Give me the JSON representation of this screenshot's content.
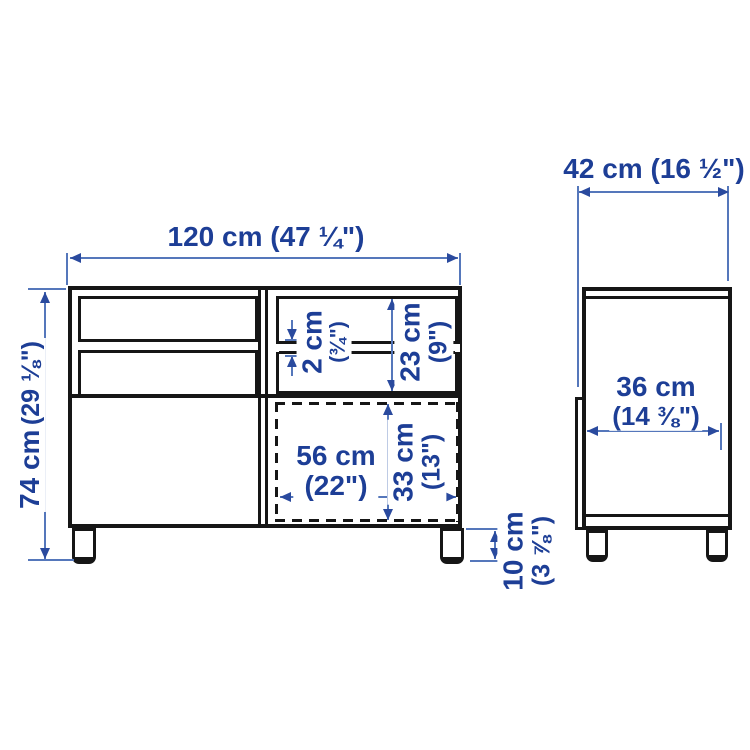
{
  "front_view": {
    "overall_width": {
      "metric": "120 cm",
      "imperial": "(47 ¼\")"
    },
    "overall_height": {
      "metric": "74 cm",
      "imperial": "(29 ⅛\")"
    },
    "shelf_thickness": {
      "metric": "2 cm",
      "imperial": "(¾\")"
    },
    "compartment_height": {
      "metric": "23 cm",
      "imperial": "(9\")"
    },
    "opening_width": {
      "metric": "56 cm",
      "imperial": "(22\")"
    },
    "opening_height": {
      "metric": "33 cm",
      "imperial": "(13\")"
    },
    "leg_height": {
      "metric": "10 cm",
      "imperial": "(3 ⅞\")"
    }
  },
  "side_view": {
    "overall_depth": {
      "metric": "42 cm",
      "imperial": "(16 ½\")"
    },
    "interior_depth": {
      "metric": "36 cm",
      "imperial": "(14 ⅜\")"
    }
  },
  "colors": {
    "outline": "#161616",
    "dimension_line": "#5577bb",
    "arrowhead": "#2a4a9e",
    "label_text": "#1d3e96",
    "background": "#ffffff"
  }
}
